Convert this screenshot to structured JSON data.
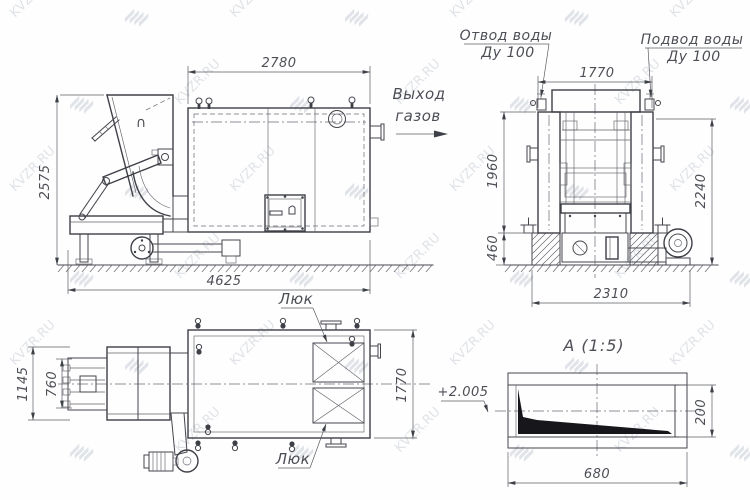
{
  "watermark": {
    "text": "KVZR.RU"
  },
  "side_view": {
    "hopper_symbol": "∩",
    "dim_body_width": "2780",
    "dim_total_height": "2575",
    "dim_total_length": "4625"
  },
  "front_view": {
    "label_gas_out_line1": "Выход",
    "label_gas_out_line2": "газов",
    "label_water_outlet_line1": "Отвод воды",
    "label_water_outlet_line2": "Ду 100",
    "label_water_inlet_line1": "Подвод воды",
    "label_water_inlet_line2": "Ду 100",
    "dim_width_top": "1770",
    "dim_height_body": "1960",
    "dim_height_base": "460",
    "dim_height_total": "2240",
    "dim_width_bottom": "2310"
  },
  "plan_view": {
    "label_hatch_top": "Люк",
    "label_hatch_bottom": "Люк",
    "dim_feeder_overall": "1145",
    "dim_feeder_inner": "760",
    "dim_body_width": "1770"
  },
  "detail_view": {
    "title": "А  (1:5)",
    "label_elevation": "+2.005",
    "dim_length": "680",
    "dim_height": "200"
  }
}
